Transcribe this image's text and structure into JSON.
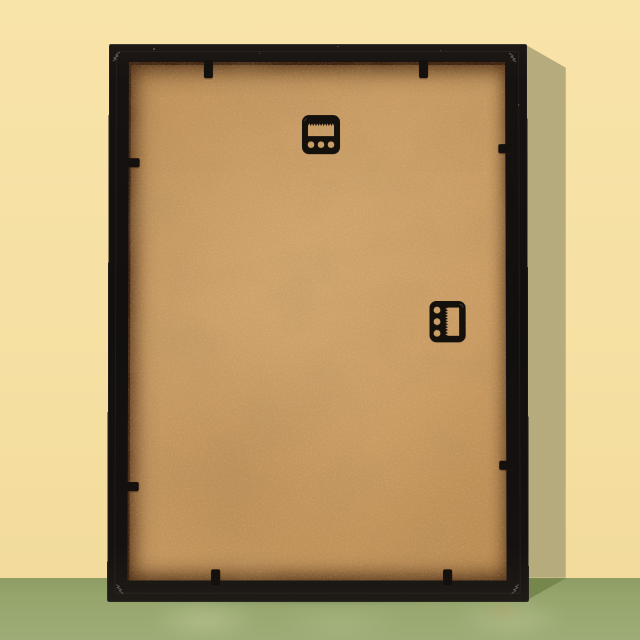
{
  "scene": {
    "description": "Back view of a black picture frame with a tan MDF hardboard backing, leaning against a pale yellow wall on a muted green surface; shadow cast to the right",
    "objects": {
      "frame": {
        "label": "black picture frame (rear)"
      },
      "backing": {
        "label": "MDF hardboard backing"
      },
      "hangers": [
        {
          "label": "sawtooth hanger, horizontal, top center"
        },
        {
          "label": "sawtooth hanger, vertical, middle right"
        }
      ],
      "retaining_tabs_count": 8,
      "corner_fasteners_count": 4
    },
    "colors": {
      "wall": "#f6e0a3",
      "wall_hi": "#f8e3a9",
      "wall_lo": "#f2db9c",
      "wall_shadow": "#b5ab7d",
      "floor": "#96a56c",
      "floor_hi": "#9ead78",
      "floor_dk": "#8d9d63",
      "floor_shadow": "#76874e",
      "frame": "#16120f",
      "backing": "#ca9b61",
      "backing_shadow": "#5e3418"
    }
  }
}
